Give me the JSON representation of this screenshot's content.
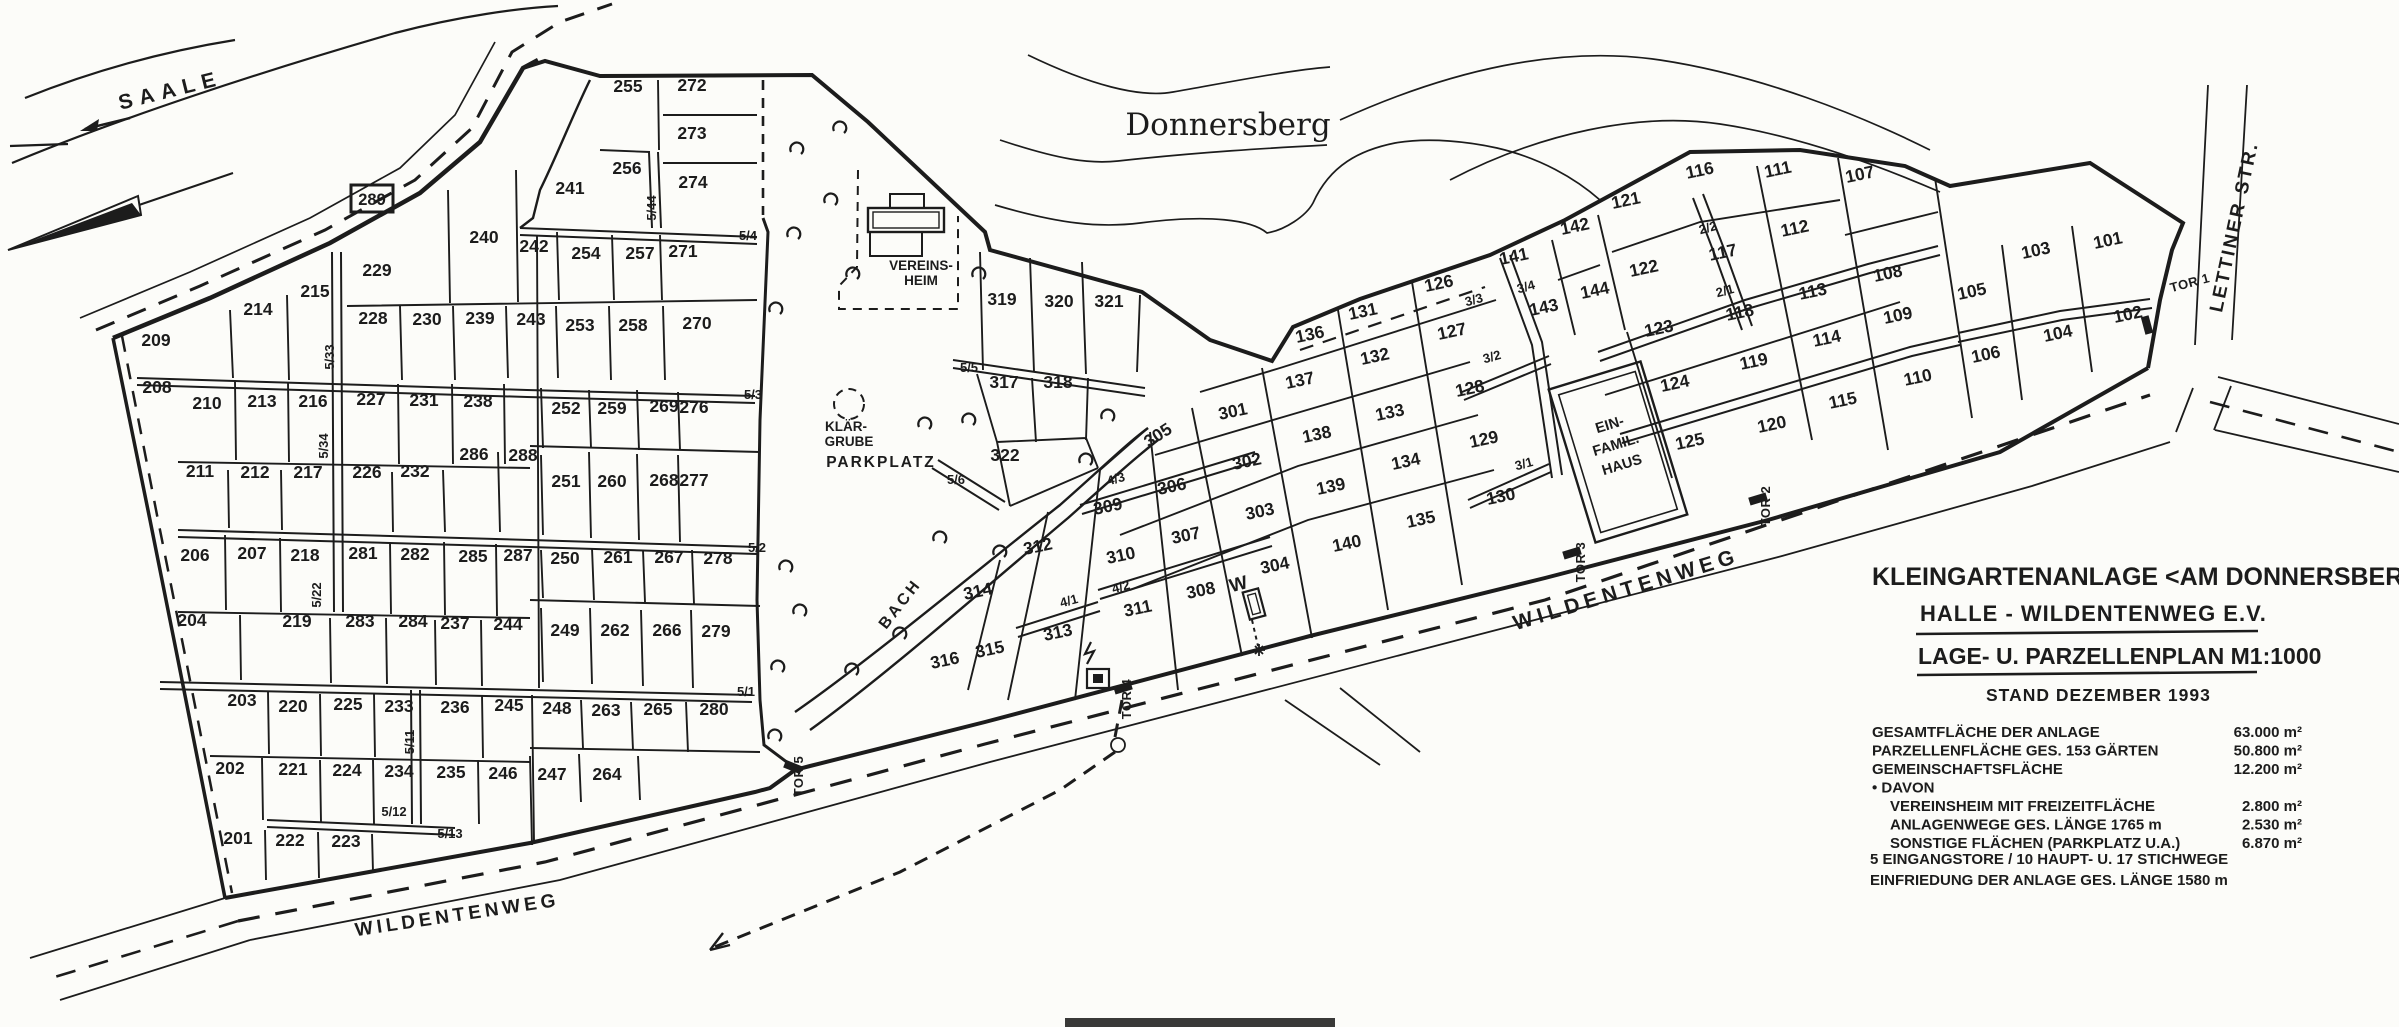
{
  "map": {
    "river": "SAALE",
    "hill": "Donnersberg",
    "streets": {
      "wildentenweg_sw": "WILDENTENWEG",
      "wildentenweg_mid": "WILDENTENWEG",
      "lettiner": "LETTINER STR."
    },
    "facilities": {
      "vereinsheim_l1": "VEREINS-",
      "vereinsheim_l2": "HEIM",
      "klaergrube_l1": "KLÄR-",
      "klaergrube_l2": "GRUBE",
      "parkplatz": "PARKPLATZ",
      "bach": "BACH",
      "efh_l1": "EIN-",
      "efh_l2": "FAMIL.",
      "efh_l3": "HAUS",
      "ref_box": "289",
      "water_mark": "W"
    },
    "legend": {
      "line1": "KLEINGARTENANLAGE <AM DONNERSBERG>",
      "line2": "HALLE - WILDENTENWEG  E.V.",
      "line3": "LAGE- U. PARZELLENPLAN  M1:1000",
      "line4": "STAND DEZEMBER 1993",
      "stats": [
        {
          "label": "GESAMTFLÄCHE DER ANLAGE",
          "value": "63.000 m²",
          "indent": false
        },
        {
          "label": "PARZELLENFLÄCHE  GES. 153 GÄRTEN",
          "value": "50.800 m²",
          "indent": false
        },
        {
          "label": "GEMEINSCHAFTSFLÄCHE",
          "value": "12.200 m²",
          "indent": false
        },
        {
          "label": "• DAVON",
          "value": "",
          "indent": false
        },
        {
          "label": "VEREINSHEIM MIT FREIZEITFLÄCHE",
          "value": "2.800 m²",
          "indent": true
        },
        {
          "label": "ANLAGENWEGE GES. LÄNGE 1765 m",
          "value": "2.530 m²",
          "indent": true
        },
        {
          "label": "SONSTIGE FLÄCHEN (PARKPLATZ U.A.)",
          "value": "6.870 m²",
          "indent": true
        }
      ],
      "note1": "5 EINGANGSTORE / 10 HAUPT- U. 17 STICHWEGE",
      "note2": "EINFRIEDUNG DER ANLAGE  GES. LÄNGE 1580 m"
    },
    "gates": [
      [
        "TOR 1",
        2191,
        287,
        -15
      ],
      [
        "TOR 2",
        1770,
        506,
        -90
      ],
      [
        "TOR 3",
        1585,
        562,
        -90
      ],
      [
        "TOR 4",
        1131,
        699,
        -90
      ],
      [
        "TOR 5",
        803,
        776,
        -90
      ]
    ],
    "path_labels": [
      [
        "5/33",
        334,
        357,
        -90
      ],
      [
        "5/34",
        328,
        446,
        -90
      ],
      [
        "5/22",
        321,
        595,
        -90
      ],
      [
        "5/11",
        414,
        742,
        -90
      ],
      [
        "5/44",
        656,
        208,
        -90
      ],
      [
        "5/4",
        748,
        240,
        0
      ],
      [
        "5/3",
        753,
        399,
        0
      ],
      [
        "5/2",
        757,
        552,
        0
      ],
      [
        "5/1",
        746,
        696,
        0
      ],
      [
        "5/12",
        394,
        816,
        0
      ],
      [
        "5/13",
        450,
        838,
        0
      ],
      [
        "5/5",
        969,
        372,
        0
      ],
      [
        "5/6",
        956,
        484,
        0
      ],
      [
        "4/3",
        1117,
        483,
        -15
      ],
      [
        "4/2",
        1122,
        591,
        -15
      ],
      [
        "4/1",
        1070,
        605,
        -15
      ],
      [
        "3/4",
        1527,
        291,
        -15
      ],
      [
        "3/3",
        1475,
        304,
        -15
      ],
      [
        "3/2",
        1493,
        361,
        -15
      ],
      [
        "3/1",
        1525,
        468,
        -15
      ],
      [
        "2/2",
        1709,
        232,
        -15
      ],
      [
        "2/1",
        1726,
        295,
        -15
      ]
    ],
    "plots": [
      [
        "209",
        156,
        346,
        0
      ],
      [
        "208",
        157,
        393,
        0
      ],
      [
        "214",
        258,
        315,
        0
      ],
      [
        "215",
        315,
        297,
        0
      ],
      [
        "229",
        377,
        276,
        0
      ],
      [
        "240",
        484,
        243,
        0
      ],
      [
        "242",
        534,
        252,
        0
      ],
      [
        "241",
        570,
        194,
        0
      ],
      [
        "228",
        373,
        324,
        0
      ],
      [
        "230",
        427,
        325,
        0
      ],
      [
        "239",
        480,
        324,
        0
      ],
      [
        "243",
        531,
        325,
        0
      ],
      [
        "210",
        207,
        409,
        0
      ],
      [
        "213",
        262,
        407,
        0
      ],
      [
        "216",
        313,
        407,
        0
      ],
      [
        "227",
        371,
        405,
        0
      ],
      [
        "231",
        424,
        406,
        0
      ],
      [
        "238",
        478,
        407,
        0
      ],
      [
        "211",
        200,
        477,
        0
      ],
      [
        "212",
        255,
        478,
        0
      ],
      [
        "217",
        308,
        478,
        0
      ],
      [
        "226",
        367,
        478,
        0
      ],
      [
        "232",
        415,
        477,
        0
      ],
      [
        "286",
        474,
        460,
        0
      ],
      [
        "288",
        523,
        461,
        0
      ],
      [
        "206",
        195,
        561,
        0
      ],
      [
        "207",
        252,
        559,
        0
      ],
      [
        "218",
        305,
        561,
        0
      ],
      [
        "281",
        363,
        559,
        0
      ],
      [
        "282",
        415,
        560,
        0
      ],
      [
        "285",
        473,
        562,
        0
      ],
      [
        "287",
        518,
        561,
        0
      ],
      [
        "204",
        192,
        626,
        0
      ],
      [
        "219",
        297,
        627,
        0
      ],
      [
        "283",
        360,
        627,
        0
      ],
      [
        "284",
        413,
        627,
        0
      ],
      [
        "237",
        455,
        629,
        0
      ],
      [
        "244",
        508,
        630,
        0
      ],
      [
        "203",
        242,
        706,
        0
      ],
      [
        "220",
        293,
        712,
        0
      ],
      [
        "225",
        348,
        710,
        0
      ],
      [
        "233",
        399,
        712,
        0
      ],
      [
        "236",
        455,
        713,
        0
      ],
      [
        "245",
        509,
        711,
        0
      ],
      [
        "202",
        230,
        774,
        0
      ],
      [
        "221",
        293,
        775,
        0
      ],
      [
        "224",
        347,
        776,
        0
      ],
      [
        "234",
        399,
        777,
        0
      ],
      [
        "235",
        451,
        778,
        0
      ],
      [
        "246",
        503,
        779,
        0
      ],
      [
        "201",
        238,
        844,
        0
      ],
      [
        "222",
        290,
        846,
        0
      ],
      [
        "223",
        346,
        847,
        0
      ],
      [
        "255",
        628,
        92,
        0
      ],
      [
        "272",
        692,
        91,
        0
      ],
      [
        "273",
        692,
        139,
        0
      ],
      [
        "256",
        627,
        174,
        0
      ],
      [
        "274",
        693,
        188,
        0
      ],
      [
        "254",
        586,
        259,
        0
      ],
      [
        "257",
        640,
        259,
        0
      ],
      [
        "271",
        683,
        257,
        0
      ],
      [
        "253",
        580,
        331,
        0
      ],
      [
        "258",
        633,
        331,
        0
      ],
      [
        "270",
        697,
        329,
        0
      ],
      [
        "252",
        566,
        414,
        0
      ],
      [
        "259",
        612,
        414,
        0
      ],
      [
        "269",
        664,
        412,
        0
      ],
      [
        "276",
        694,
        413,
        0
      ],
      [
        "251",
        566,
        487,
        0
      ],
      [
        "260",
        612,
        487,
        0
      ],
      [
        "268",
        664,
        486,
        0
      ],
      [
        "277",
        694,
        486,
        0
      ],
      [
        "250",
        565,
        564,
        0
      ],
      [
        "261",
        618,
        563,
        0
      ],
      [
        "267",
        669,
        563,
        0
      ],
      [
        "278",
        718,
        564,
        0
      ],
      [
        "249",
        565,
        636,
        0
      ],
      [
        "262",
        615,
        636,
        0
      ],
      [
        "266",
        667,
        636,
        0
      ],
      [
        "279",
        716,
        637,
        0
      ],
      [
        "248",
        557,
        714,
        0
      ],
      [
        "263",
        606,
        716,
        0
      ],
      [
        "265",
        658,
        715,
        0
      ],
      [
        "280",
        714,
        715,
        0
      ],
      [
        "247",
        552,
        780,
        0
      ],
      [
        "264",
        607,
        780,
        0
      ],
      [
        "319",
        1002,
        305,
        0
      ],
      [
        "320",
        1059,
        307,
        0
      ],
      [
        "321",
        1109,
        307,
        0
      ],
      [
        "317",
        1004,
        388,
        0
      ],
      [
        "318",
        1058,
        388,
        0
      ],
      [
        "322",
        1005,
        461,
        0
      ],
      [
        "316",
        946,
        666,
        -12
      ],
      [
        "315",
        991,
        655,
        -12
      ],
      [
        "314",
        979,
        597,
        -12
      ],
      [
        "313",
        1059,
        638,
        -12
      ],
      [
        "312",
        1039,
        552,
        -12
      ],
      [
        "309",
        1109,
        512,
        -12
      ],
      [
        "310",
        1122,
        561,
        -12
      ],
      [
        "311",
        1139,
        614,
        -12
      ],
      [
        "305",
        1161,
        440,
        -33
      ],
      [
        "306",
        1173,
        492,
        -12
      ],
      [
        "307",
        1187,
        541,
        -12
      ],
      [
        "308",
        1202,
        596,
        -12
      ],
      [
        "301",
        1234,
        417,
        -12
      ],
      [
        "302",
        1248,
        467,
        -12
      ],
      [
        "303",
        1261,
        517,
        -12
      ],
      [
        "304",
        1276,
        571,
        -12
      ],
      [
        "136",
        1311,
        340,
        -12
      ],
      [
        "137",
        1301,
        386,
        -12
      ],
      [
        "138",
        1318,
        440,
        -12
      ],
      [
        "139",
        1332,
        492,
        -12
      ],
      [
        "140",
        1348,
        549,
        -12
      ],
      [
        "131",
        1364,
        317,
        -12
      ],
      [
        "132",
        1376,
        362,
        -12
      ],
      [
        "133",
        1391,
        418,
        -12
      ],
      [
        "134",
        1407,
        467,
        -12
      ],
      [
        "135",
        1422,
        525,
        -12
      ],
      [
        "126",
        1440,
        289,
        -12
      ],
      [
        "127",
        1453,
        337,
        -12
      ],
      [
        "128",
        1471,
        394,
        -12
      ],
      [
        "129",
        1485,
        445,
        -12
      ],
      [
        "130",
        1502,
        502,
        -12
      ],
      [
        "141",
        1515,
        262,
        -12
      ],
      [
        "143",
        1545,
        313,
        -12
      ],
      [
        "142",
        1576,
        232,
        -12
      ],
      [
        "144",
        1596,
        296,
        -12
      ],
      [
        "121",
        1627,
        206,
        -12
      ],
      [
        "122",
        1645,
        274,
        -12
      ],
      [
        "123",
        1660,
        334,
        -12
      ],
      [
        "124",
        1676,
        389,
        -12
      ],
      [
        "125",
        1691,
        447,
        -12
      ],
      [
        "116",
        1701,
        176,
        -12
      ],
      [
        "117",
        1724,
        258,
        -12
      ],
      [
        "118",
        1741,
        318,
        -12
      ],
      [
        "119",
        1755,
        367,
        -12
      ],
      [
        "120",
        1773,
        430,
        -12
      ],
      [
        "111",
        1779,
        175,
        -12
      ],
      [
        "112",
        1796,
        234,
        -12
      ],
      [
        "113",
        1814,
        297,
        -12
      ],
      [
        "114",
        1828,
        344,
        -12
      ],
      [
        "115",
        1844,
        406,
        -12
      ],
      [
        "107",
        1861,
        180,
        -12
      ],
      [
        "108",
        1889,
        279,
        -12
      ],
      [
        "109",
        1899,
        321,
        -12
      ],
      [
        "110",
        1919,
        383,
        -12
      ],
      [
        "105",
        1973,
        297,
        -12
      ],
      [
        "103",
        2037,
        256,
        -12
      ],
      [
        "101",
        2109,
        246,
        -12
      ],
      [
        "106",
        1987,
        360,
        -12
      ],
      [
        "104",
        2059,
        339,
        -12
      ],
      [
        "102",
        2129,
        320,
        -12
      ]
    ],
    "trees": [
      [
        840,
        125
      ],
      [
        797,
        146
      ],
      [
        831,
        197
      ],
      [
        794,
        231
      ],
      [
        853,
        271
      ],
      [
        979,
        271
      ],
      [
        776,
        306
      ],
      [
        925,
        421
      ],
      [
        969,
        417
      ],
      [
        1108,
        413
      ],
      [
        1086,
        457
      ],
      [
        940,
        535
      ],
      [
        1000,
        549
      ],
      [
        852,
        667
      ],
      [
        900,
        631
      ],
      [
        786,
        564
      ],
      [
        800,
        608
      ],
      [
        778,
        664
      ],
      [
        775,
        733
      ]
    ]
  }
}
